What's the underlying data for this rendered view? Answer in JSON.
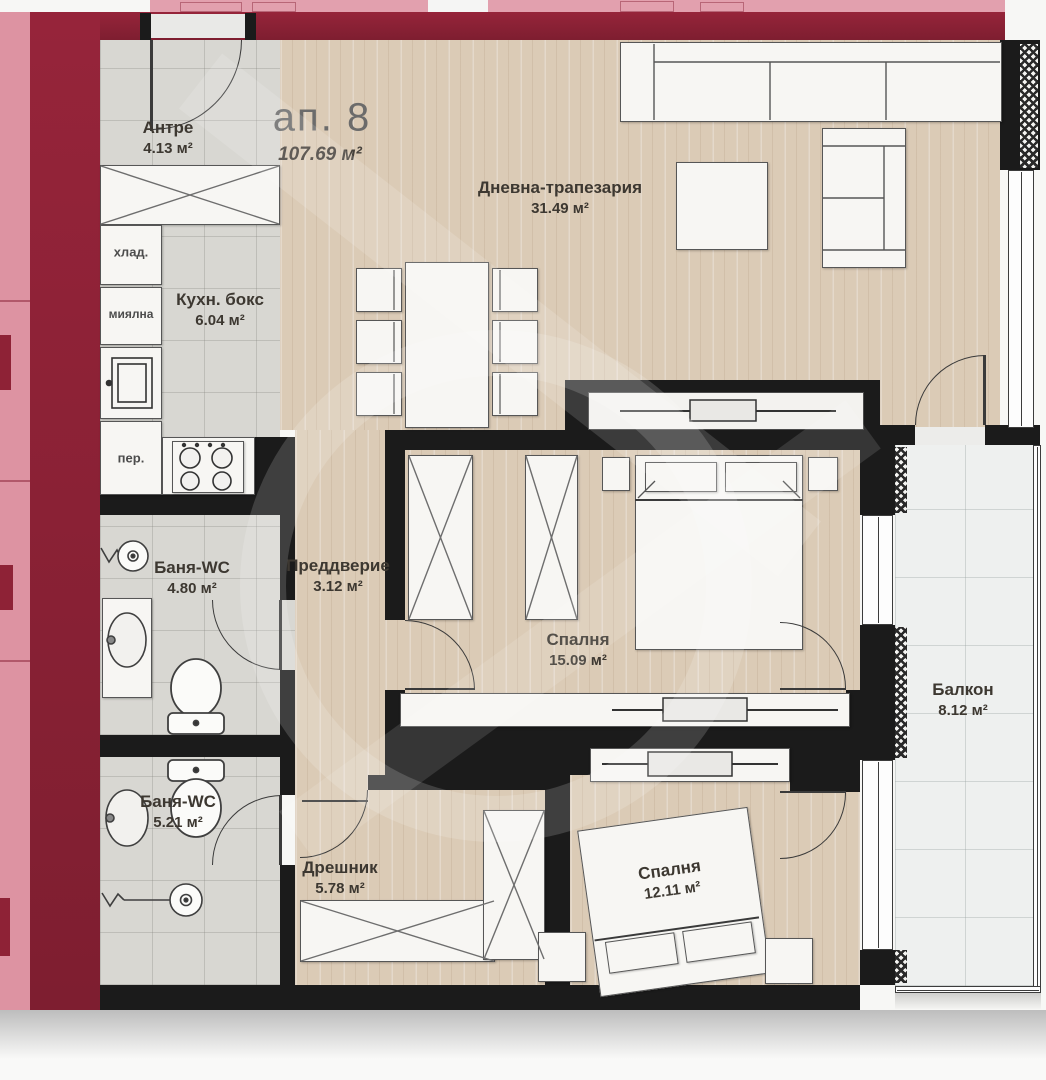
{
  "apartment": {
    "number": "ап. 8",
    "total_area": "107.69 м²"
  },
  "rooms": {
    "antre": {
      "name": "Антре",
      "area": "4.13 м²"
    },
    "living": {
      "name": "Дневна-трапезария",
      "area": "31.49 м²"
    },
    "kitchen": {
      "name": "Кухн. бокс",
      "area": "6.04 м²"
    },
    "bath1": {
      "name": "Баня-WC",
      "area": "4.80 м²"
    },
    "vestibule": {
      "name": "Преддверие",
      "area": "3.12 м²"
    },
    "bedroom1": {
      "name": "Спалня",
      "area": "15.09 м²"
    },
    "balcony": {
      "name": "Балкон",
      "area": "8.12 м²"
    },
    "bath2": {
      "name": "Баня-WC",
      "area": "5.21 м²"
    },
    "closet": {
      "name": "Дрешник",
      "area": "5.78 м²"
    },
    "bedroom2": {
      "name": "Спалня",
      "area": "12.11 м²"
    }
  },
  "kitchen_appliances": {
    "fridge": "хлад.",
    "dishwasher": "миялна",
    "washer": "пер."
  },
  "colors": {
    "party_wall": "#8a2134",
    "neighbor_fill": "#e2a0ae",
    "interior_wall": "#1b1b1b",
    "wood_floor": "#dbcbb6",
    "tile_floor": "#d8d7d2",
    "balcony_floor": "#eef0ef"
  }
}
